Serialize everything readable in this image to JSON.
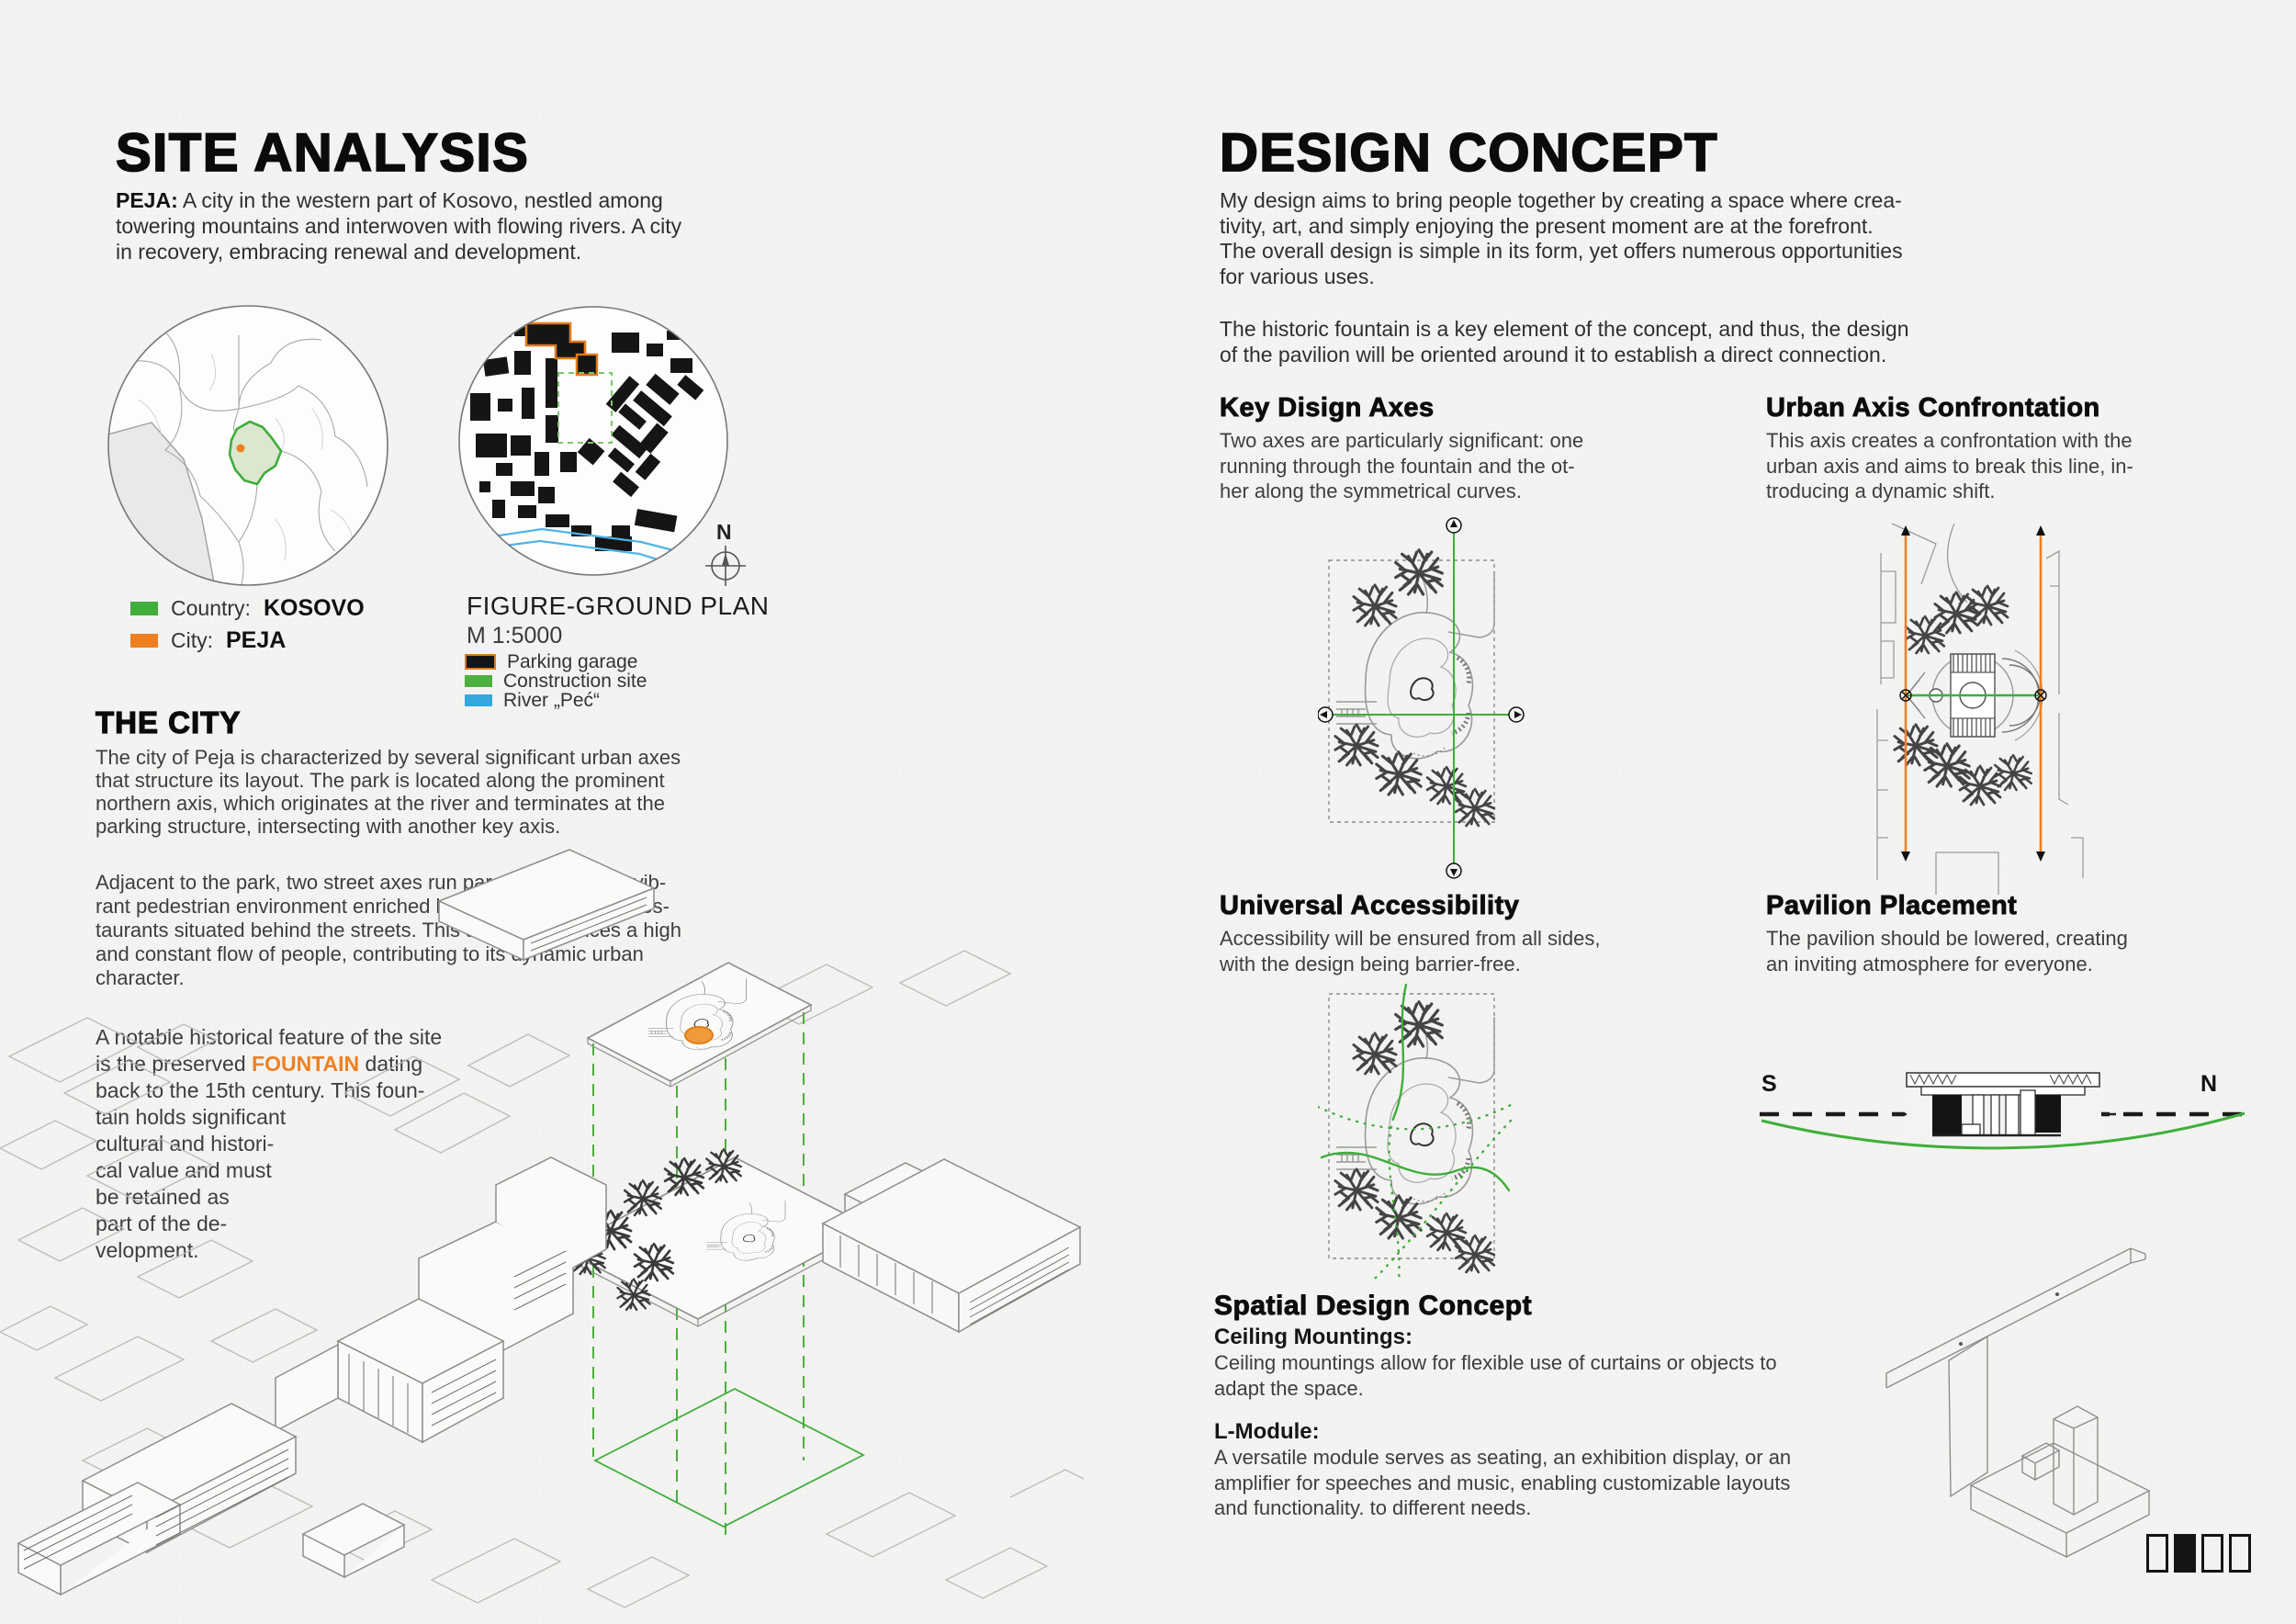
{
  "left": {
    "title": "SITE ANALYSIS",
    "intro_bold": "PEJA:",
    "intro_rest": " A city in the western part of Kosovo, nestled among\ntowering mountains and interwoven with flowing rivers. A city\nin recovery, embracing renewal and development.",
    "map_legend": {
      "country_label": "Country: ",
      "country_value": "KOSOVO",
      "city_label": "City: ",
      "city_value": "PEJA"
    },
    "figure_ground": {
      "title": "FIGURE-GROUND PLAN",
      "scale": "M 1:5000",
      "compass": "N",
      "legend": [
        {
          "label": "Parking garage"
        },
        {
          "label": "Construction site"
        },
        {
          "label": "River „Peć“"
        }
      ]
    },
    "city": {
      "heading": "THE CITY",
      "para1": "The city of Peja is characterized by several significant urban axes\nthat structure its layout. The park is located along the prominent\nnorthern axis, which originates at the river and terminates at the\nparking structure, intersecting with another key axis.",
      "para2": "Adjacent to the park, two street axes run parallel, creating a vib-\nrant pedestrian environment enriched by arcaded cafés and res-\ntaurants situated behind the streets. This area experiences a high\nand constant flow of people, contributing to its dynamic urban\ncharacter.",
      "para3_pre": "A notable historical feature of the site\nis the preserved ",
      "para3_highlight": "FOUNTAIN",
      "para3_post": " dating\nback to the 15th century. This foun-\ntain holds significant\ncultural and histori-\ncal value and must\nbe retained as\npart of the de-\nvelopment."
    }
  },
  "right": {
    "title": "DESIGN CONCEPT",
    "intro1": "My design aims to bring people together by creating a space where crea-\ntivity, art, and simply enjoying the present moment are at the forefront.\nThe overall design is simple in its form, yet offers numerous opportunities\nfor various uses.",
    "intro2": "The historic fountain is a key element of the concept, and thus, the design\nof the pavilion will be oriented around it to establish a direct connection.",
    "key_axes": {
      "heading": "Key Disign Axes",
      "body": "Two axes are particularly significant: one\nrunning through the fountain and the ot-\nher along the symmetrical curves."
    },
    "urban_axis": {
      "heading": "Urban Axis Confrontation",
      "body": "This axis creates a confrontation with the\nurban axis and aims to break this line, in-\ntroducing a dynamic shift."
    },
    "accessibility": {
      "heading": "Universal Accessibility",
      "body": "Accessibility will be ensured from all sides,\nwith the design being barrier-free."
    },
    "placement": {
      "heading": "Pavilion Placement",
      "body": "The pavilion should be lowered, creating\nan inviting atmosphere for everyone."
    },
    "section_marks": {
      "south": "S",
      "north": "N"
    },
    "spatial": {
      "heading": "Spatial Design Concept",
      "ceiling_label": "Ceiling Mountings:",
      "ceiling_body": "Ceiling mountings allow for flexible use of curtains or objects to\nadapt the space.",
      "module_label": "L-Module:",
      "module_body": "A versatile module serves as seating, an exhibition display, or an\namplifier for speeches and music, enabling customizable layouts\nand functionality. to different needs."
    }
  },
  "pager": {
    "count": 4,
    "active": 2
  },
  "colors": {
    "axis_green": "#3fae3c",
    "construction_green": "#4caf3f",
    "orange": "#ee8022",
    "river_blue": "#35a8e0",
    "kosovo_fill": "#dbe8cf"
  }
}
